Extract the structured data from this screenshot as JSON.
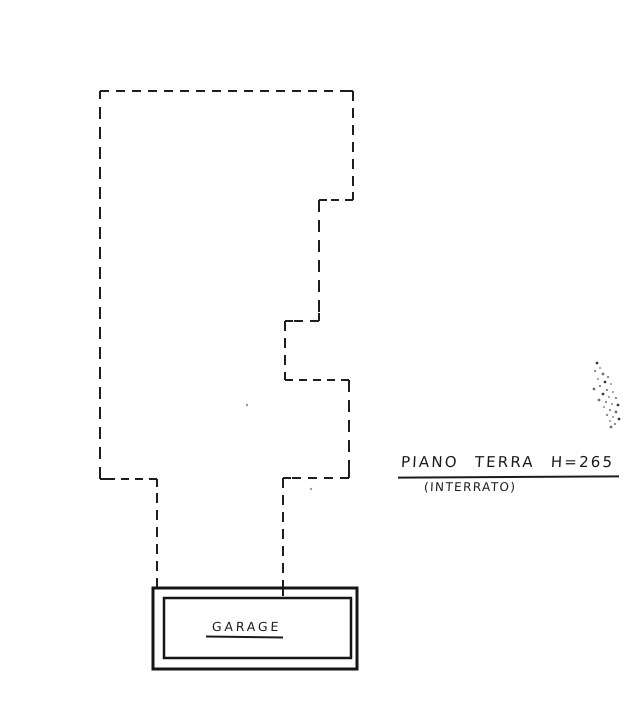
{
  "page": {
    "background": "#ffffff",
    "ink": "#1e1e1e",
    "width": 642,
    "height": 724
  },
  "labels": {
    "title": {
      "text": "PIANO TERRA H=265"
    },
    "subtitle": {
      "text": "(INTERRATO)"
    },
    "garage": {
      "text": "GARAGE"
    }
  },
  "plan": {
    "outline_dashed_polyline": [
      [
        157,
        588
      ],
      [
        157,
        479
      ],
      [
        100,
        479
      ],
      [
        100,
        91
      ],
      [
        353,
        91
      ],
      [
        353,
        200
      ],
      [
        319,
        200
      ],
      [
        319,
        321
      ],
      [
        285,
        321
      ],
      [
        285,
        380
      ],
      [
        349,
        380
      ],
      [
        349,
        478
      ],
      [
        283,
        478
      ],
      [
        283,
        596
      ]
    ],
    "dash_patterns": [
      "10 7",
      "8 6",
      "12 8",
      "9 7"
    ],
    "outline_stroke_width": 2,
    "corner_tick_length": 8,
    "garage_outer_box": {
      "x": 153,
      "y": 588,
      "w": 204,
      "h": 81,
      "stroke_width": 3
    },
    "garage_inner_box": {
      "x": 164,
      "y": 598,
      "w": 187,
      "h": 60,
      "stroke_width": 2.5
    },
    "faint_dots": [
      [
        247,
        405
      ],
      [
        311,
        489
      ]
    ],
    "speckles": [
      [
        597,
        363
      ],
      [
        600,
        368
      ],
      [
        595,
        371
      ],
      [
        603,
        374
      ],
      [
        608,
        377
      ],
      [
        598,
        379
      ],
      [
        605,
        382
      ],
      [
        611,
        384
      ],
      [
        600,
        386
      ],
      [
        594,
        389
      ],
      [
        607,
        390
      ],
      [
        613,
        392
      ],
      [
        603,
        394
      ],
      [
        609,
        397
      ],
      [
        616,
        398
      ],
      [
        599,
        400
      ],
      [
        606,
        402
      ],
      [
        612,
        404
      ],
      [
        618,
        405
      ],
      [
        604,
        407
      ],
      [
        610,
        410
      ],
      [
        616,
        412
      ],
      [
        607,
        415
      ],
      [
        613,
        417
      ],
      [
        619,
        419
      ],
      [
        610,
        421
      ],
      [
        615,
        424
      ],
      [
        611,
        427
      ]
    ]
  }
}
